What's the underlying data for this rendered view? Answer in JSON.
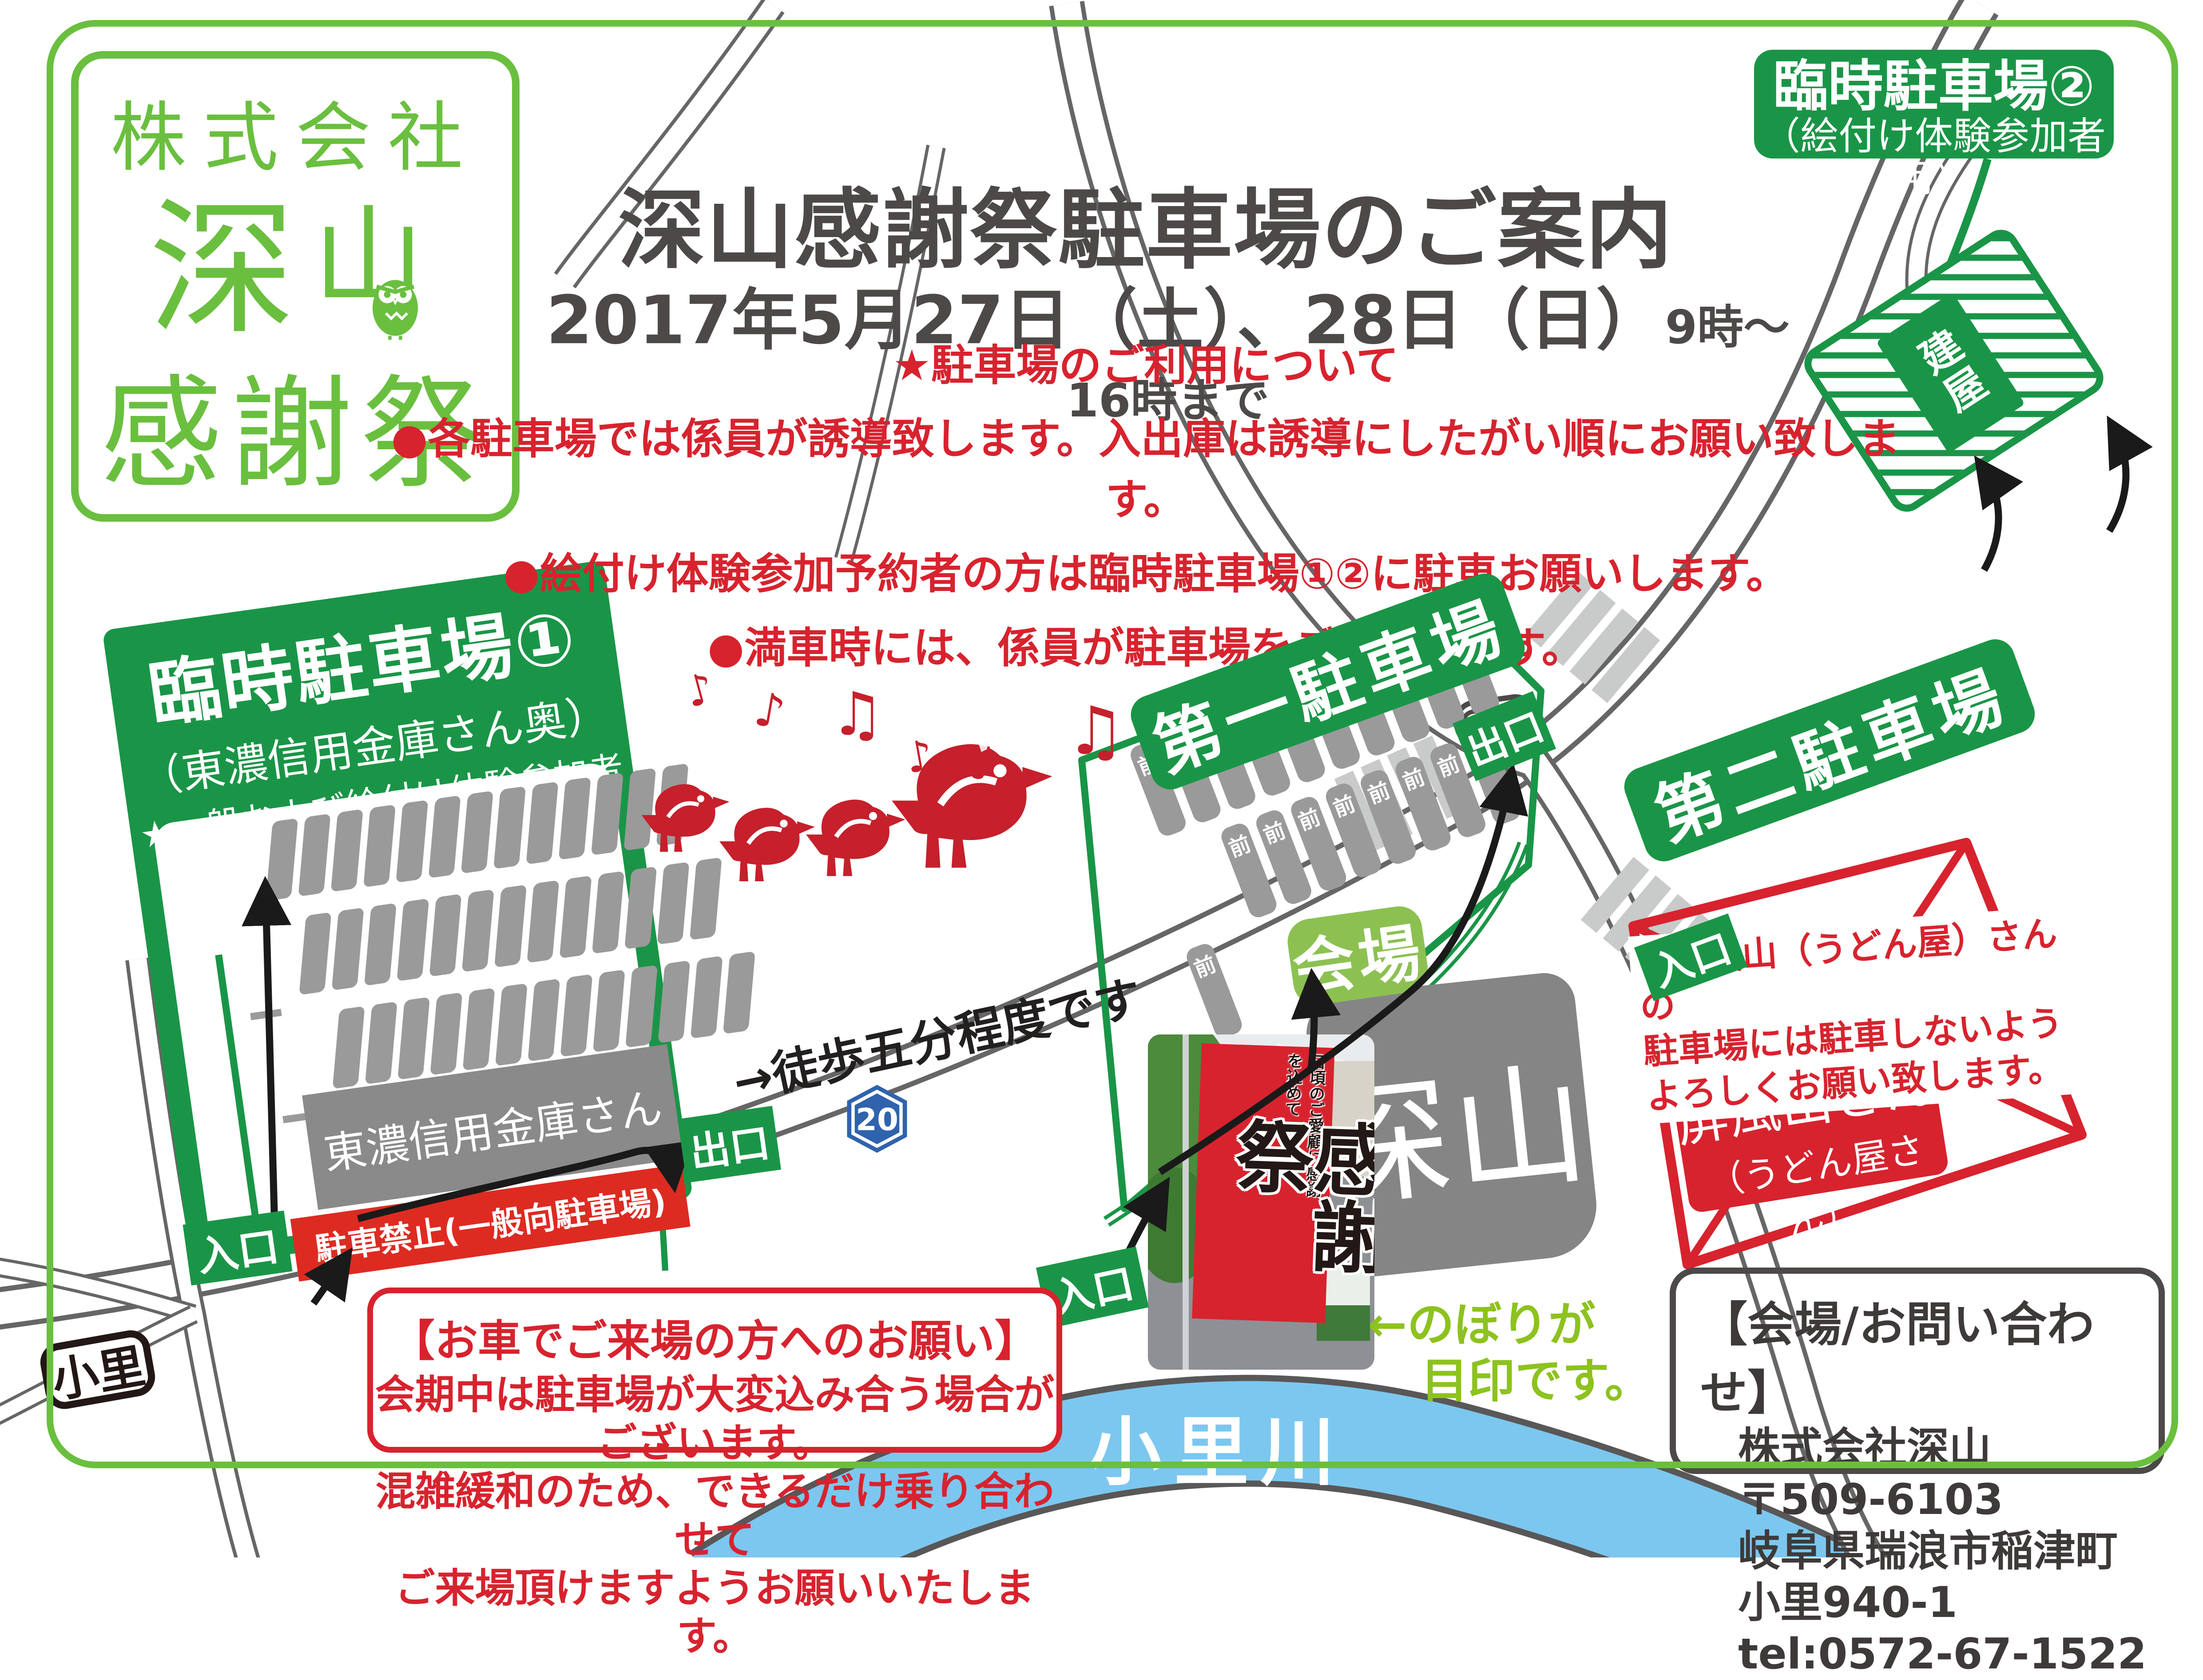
{
  "colors": {
    "brand_green": "#6abf3f",
    "dark_green": "#1a9547",
    "leaf_green": "#8cc152",
    "note_green": "#8dc21f",
    "red": "#d7232e",
    "box_red": "#dd2b22",
    "title_gray": "#4c4948",
    "stall_gray": "#9a9a9a",
    "river_blue": "#7cc7ef"
  },
  "logo": {
    "company": "株式会社",
    "name_main": "深",
    "name_sub": "山",
    "event": "感謝祭"
  },
  "header": {
    "title": "深山感謝祭駐車場のご案内",
    "date": "2017年5月27日（土）、28日（日）",
    "time": "9時〜16時まで"
  },
  "notices": {
    "heading": "★駐車場のご利用について",
    "items": [
      "●各駐車場では係員が誘導致します。入出庫は誘導にしたがい順にお願い致します。",
      "●絵付け体験参加予約者の方は臨時駐車場①②に駐車お願いします。",
      "●満車時には、係員が駐車場をご案内します。"
    ]
  },
  "rinji2": {
    "title": "臨時駐車場②",
    "subtitle": "（絵付け体験参加者用）",
    "building": "建屋"
  },
  "rinji1": {
    "title": "臨時駐車場①",
    "subtitle": "（東濃信用金庫さん奥）",
    "note": "★一般および絵付け体験参加者用",
    "bank": "東濃信用金庫さん",
    "no_parking": "駐車禁止(一般向駐車場)",
    "entrance": "入口",
    "exit": "出口"
  },
  "lot_daiichi": {
    "title": "第一駐車場",
    "stall_label": "前",
    "entrance": "入口",
    "exit": "出口"
  },
  "lot_daini": {
    "title": "第二駐車場",
    "entrance": "入口"
  },
  "byobu": {
    "warning_lines": [
      "＊屏風山（うどん屋）さんの",
      "駐車場には駐車しないよう",
      "よろしくお願い致します。"
    ],
    "name": "屏風山さん",
    "name_sub": "（うどん屋さん）"
  },
  "venue": {
    "label": "会場",
    "name": "深山",
    "nobori_note_line1": "←のぼりが",
    "nobori_note_line2": "目印です。",
    "walk_note": "→徒歩五分程度です",
    "route_number": "20"
  },
  "photo": {
    "banner_main": "感謝祭",
    "banner_small": "日頃のご愛顧に感謝を込めて"
  },
  "request": {
    "title": "【お車でご来場の方へのお願い】",
    "lines": [
      "会期中は駐車場が大変込み合う場合がございます。",
      "混雑緩和のため、できるだけ乗り合わせて",
      "ご来場頂けますようお願いいたします。"
    ]
  },
  "contact": {
    "title": "【会場/お問い合わせ】",
    "company": "株式会社深山",
    "postal": "〒509-6103",
    "address": "岐阜県瑞浪市稲津町小里940-1",
    "tel": "tel:0572-67-1522"
  },
  "map_labels": {
    "ori": "小里",
    "river": "小里川"
  },
  "ducks": {
    "notes": [
      "♪",
      "♪",
      "♫",
      "♪",
      "♪",
      "♫"
    ]
  },
  "parking": {
    "rinji1_rows": [
      13,
      13,
      13
    ],
    "daiichi_rows": [
      10,
      8,
      1
    ]
  }
}
